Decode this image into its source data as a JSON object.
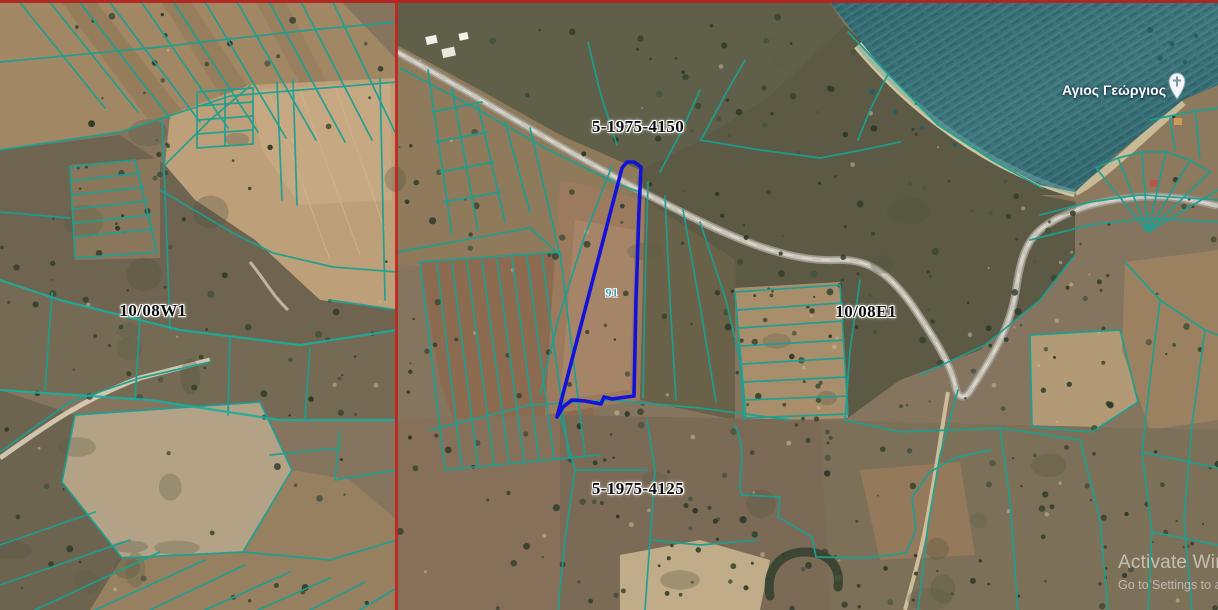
{
  "map": {
    "block_labels": [
      {
        "id": "plan-4150",
        "text": "5-1975-4150"
      },
      {
        "id": "plan-4125",
        "text": "5-1975-4125"
      },
      {
        "id": "sheet-10-08W1",
        "text": "10/08W1"
      },
      {
        "id": "sheet-10-08E1",
        "text": "10/08E1"
      }
    ],
    "selected_parcel": {
      "number": "91"
    },
    "poi": {
      "name": "Αγιος Γεώργιος",
      "icon": "church-pin-icon"
    },
    "colors": {
      "cadastral_line": "#1aa092",
      "selected_parcel_outline": "#1412d8",
      "sheet_boundary_red": "#c0241e",
      "water": "#38707a"
    }
  },
  "watermark": {
    "line1": "Activate Windo",
    "line2": "Go to Settings to a"
  }
}
